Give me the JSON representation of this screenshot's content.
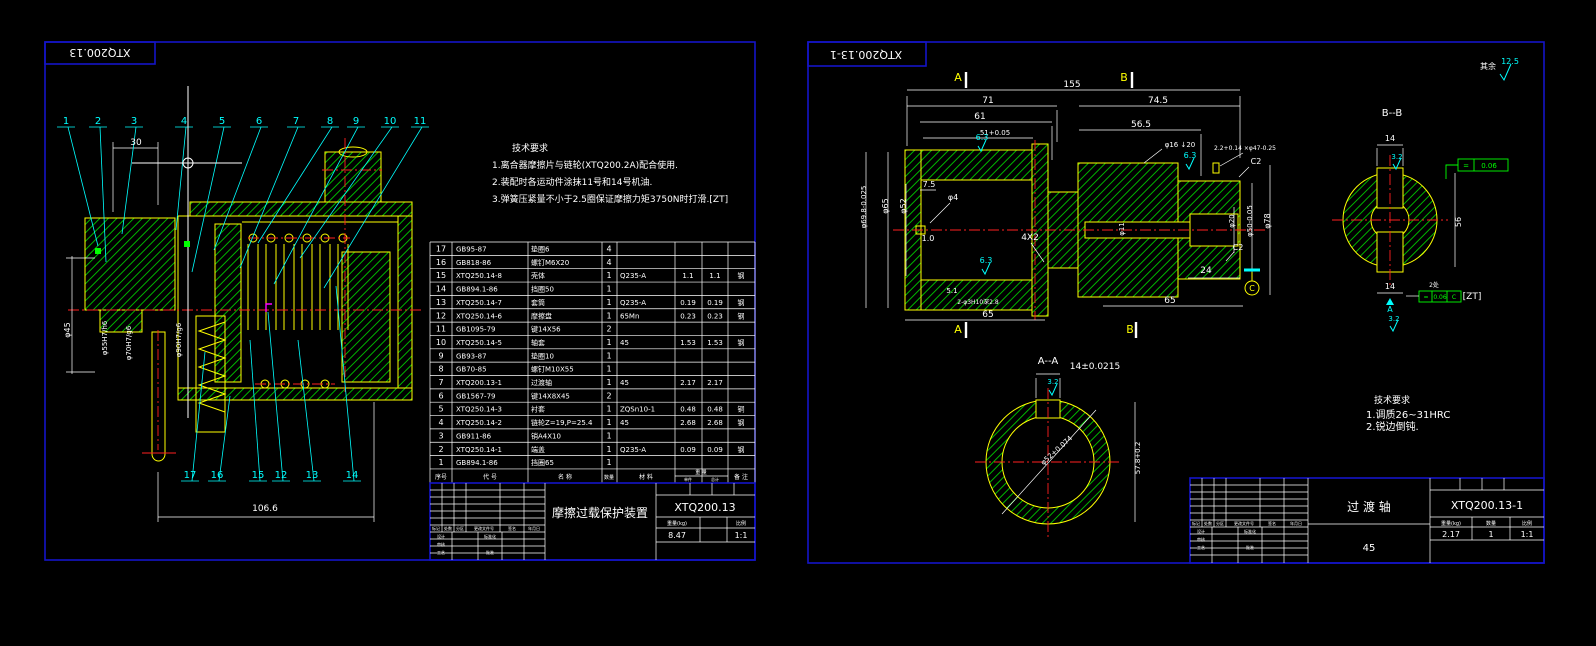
{
  "palette": {
    "background": "#000000",
    "frame_blue": "#1414c8",
    "entity_yellow": "#ffff00",
    "hatch_green": "#00b400",
    "dim_white": "#ffffff",
    "leader_cyan": "#00ffff",
    "center_red": "#ff2020",
    "tolerance_green": "#00ff00",
    "highlight_magenta": "#ff00ff"
  },
  "left_sheet": {
    "corner_label": "XTQ200.13",
    "callouts_top": [
      "1",
      "2",
      "3",
      "4",
      "5",
      "6",
      "7",
      "8",
      "9",
      "10",
      "11"
    ],
    "callouts_bottom": [
      "17",
      "16",
      "15",
      "12",
      "13",
      "14"
    ],
    "dimensions": [
      {
        "t": "30",
        "x": 136,
        "y": 145
      },
      {
        "t": "106.6",
        "x": 265,
        "y": 511
      },
      {
        "t": "φ45",
        "x": 70,
        "y": 330,
        "r": -90,
        "fs": 8
      },
      {
        "t": "φ55H7/h6",
        "x": 107,
        "y": 338,
        "r": -90,
        "fs": 7
      },
      {
        "t": "φ70H7/g6",
        "x": 131,
        "y": 343,
        "r": -90,
        "fs": 7
      },
      {
        "t": "φ90H7/g6",
        "x": 181,
        "y": 340,
        "r": -90,
        "fs": 7
      }
    ],
    "tech_req": {
      "title": "技术要求",
      "lines": [
        "1.离合器摩擦片与链轮(XTQ200.2A)配合使用.",
        "2.装配时各运动件涂抹11号和14号机油.",
        "3.弹簧压紧量不小于2.5圈保证摩擦力矩3750N时打滑.[ZT]"
      ]
    },
    "bom": {
      "header": {
        "no": "序号",
        "code": "代  号",
        "name": "名  称",
        "qty": "数量",
        "mat": "材  料",
        "weight": "重 量",
        "unit": "单件",
        "total": "总计",
        "note": "备  注"
      },
      "rows": [
        [
          "17",
          "GB95-87",
          "垫圈6",
          "4",
          "",
          "",
          "",
          ""
        ],
        [
          "16",
          "GB818-86",
          "螺钉M6X20",
          "4",
          "",
          "",
          "",
          ""
        ],
        [
          "15",
          "XTQ250.14-8",
          "壳体",
          "1",
          "Q235-A",
          "1.1",
          "1.1",
          "钢"
        ],
        [
          "14",
          "GB894.1-86",
          "挡圈50",
          "1",
          "",
          "",
          "",
          ""
        ],
        [
          "13",
          "XTQ250.14-7",
          "套筒",
          "1",
          "Q235-A",
          "0.19",
          "0.19",
          "钢"
        ],
        [
          "12",
          "XTQ250.14-6",
          "摩擦盘",
          "1",
          "65Mn",
          "0.23",
          "0.23",
          "钢"
        ],
        [
          "11",
          "GB1095-79",
          "键14X56",
          "2",
          "",
          "",
          "",
          ""
        ],
        [
          "10",
          "XTQ250.14-5",
          "轴套",
          "1",
          "45",
          "1.53",
          "1.53",
          "钢"
        ],
        [
          "9",
          "GB93-87",
          "垫圈10",
          "1",
          "",
          "",
          "",
          ""
        ],
        [
          "8",
          "GB70-85",
          "螺钉M10X55",
          "1",
          "",
          "",
          "",
          ""
        ],
        [
          "7",
          "XTQ200.13-1",
          "过渡轴",
          "1",
          "45",
          "2.17",
          "2.17",
          ""
        ],
        [
          "6",
          "GB1567-79",
          "键14X8X45",
          "2",
          "",
          "",
          "",
          ""
        ],
        [
          "5",
          "XTQ250.14-3",
          "衬套",
          "1",
          "ZQSn10-1",
          "0.48",
          "0.48",
          "铜"
        ],
        [
          "4",
          "XTQ250.14-2",
          "链轮Z=19,P=25.4",
          "1",
          "45",
          "2.68",
          "2.68",
          "钢"
        ],
        [
          "3",
          "GB911-86",
          "销A4X10",
          "1",
          "",
          "",
          "",
          ""
        ],
        [
          "2",
          "XTQ250.14-1",
          "端盖",
          "1",
          "Q235-A",
          "0.09",
          "0.09",
          "钢"
        ],
        [
          "1",
          "GB894.1-86",
          "挡圈65",
          "1",
          "",
          "",
          "",
          ""
        ]
      ]
    },
    "title_block": {
      "product_name": "摩擦过载保护装置",
      "drawing_no": "XTQ200.13",
      "weight": "8.47",
      "scale": "1:1",
      "labels": {
        "mark": "标记",
        "count": "处数",
        "zone": "分区",
        "doc": "更改文件号",
        "sign": "签名",
        "date": "年月日",
        "design": "设计",
        "check": "审核",
        "process": "工艺",
        "std": "标准化",
        "approve": "批准",
        "weight_kg": "重量(kg)",
        "scale_l": "比例"
      }
    }
  },
  "right_sheet": {
    "corner_label": "XTQ200.13-1",
    "surface_note": {
      "prefix": "其余",
      "roughness": "12.5"
    },
    "section_labels": [
      "A",
      "B",
      "A",
      "B"
    ],
    "dimensions": [
      {
        "t": "155",
        "x": 1072,
        "y": 87
      },
      {
        "t": "71",
        "x": 988,
        "y": 103
      },
      {
        "t": "61",
        "x": 980,
        "y": 119
      },
      {
        "t": "51+0.05",
        "x": 995,
        "y": 135,
        "fs": 7
      },
      {
        "t": "74.5",
        "x": 1158,
        "y": 103
      },
      {
        "t": "56.5",
        "x": 1141,
        "y": 127
      },
      {
        "t": "7.5",
        "x": 929,
        "y": 187,
        "fs": 8
      },
      {
        "t": "φ4",
        "x": 953,
        "y": 200,
        "fs": 8
      },
      {
        "t": "1.0",
        "x": 928,
        "y": 241,
        "fs": 8
      },
      {
        "t": "4X2",
        "x": 1030,
        "y": 240,
        "fs": 9
      },
      {
        "t": "5.1",
        "x": 952,
        "y": 293,
        "fs": 7
      },
      {
        "t": "2-φ3H10深2.8",
        "x": 978,
        "y": 304,
        "fs": 6
      },
      {
        "t": "65",
        "x": 988,
        "y": 317
      },
      {
        "t": "65",
        "x": 1170,
        "y": 303
      },
      {
        "t": "24",
        "x": 1206,
        "y": 273
      },
      {
        "t": "φ16 ↓20",
        "x": 1180,
        "y": 147,
        "fs": 7
      },
      {
        "t": "2.2+0.14 ×φ47-0.25",
        "x": 1245,
        "y": 150,
        "fs": 6
      },
      {
        "t": "C2",
        "x": 1256,
        "y": 164,
        "fs": 8
      },
      {
        "t": "C2",
        "x": 1238,
        "y": 250,
        "fs": 8
      },
      {
        "t": "6.3",
        "x": 982,
        "y": 140,
        "c": "c",
        "fs": 8
      },
      {
        "t": "6.3",
        "x": 1190,
        "y": 158,
        "c": "c",
        "fs": 8
      },
      {
        "t": "6.3",
        "x": 986,
        "y": 263,
        "c": "c",
        "fs": 8
      },
      {
        "t": "φ69.8-0.025",
        "x": 866,
        "y": 207,
        "r": -90,
        "fs": 7
      },
      {
        "t": "φ65",
        "x": 888,
        "y": 206,
        "r": -90,
        "fs": 8
      },
      {
        "t": "φ52",
        "x": 906,
        "y": 206,
        "r": -90,
        "fs": 8
      },
      {
        "t": "φ11",
        "x": 1124,
        "y": 229,
        "r": -90,
        "fs": 7
      },
      {
        "t": "φ20",
        "x": 1234,
        "y": 221,
        "r": -90,
        "fs": 7
      },
      {
        "t": "φ50-0.05",
        "x": 1252,
        "y": 221,
        "r": -90,
        "fs": 7
      },
      {
        "t": "φ78",
        "x": 1270,
        "y": 221,
        "r": -90,
        "fs": 8
      },
      {
        "t": "B--B",
        "x": 1392,
        "y": 116,
        "fs": 10
      },
      {
        "t": "14",
        "x": 1390,
        "y": 141,
        "fs": 8
      },
      {
        "t": "3.2",
        "x": 1397,
        "y": 159,
        "c": "c",
        "fs": 7
      },
      {
        "t": "56",
        "x": 1461,
        "y": 222,
        "r": -90,
        "fs": 8
      },
      {
        "t": "14",
        "x": 1390,
        "y": 289,
        "fs": 8
      },
      {
        "t": "2处",
        "x": 1434,
        "y": 287,
        "fs": 6
      },
      {
        "t": "=",
        "x": 1466,
        "y": 168,
        "c": "g",
        "fs": 7
      },
      {
        "t": "0.06",
        "x": 1489,
        "y": 168,
        "c": "g",
        "fs": 7
      },
      {
        "t": "=",
        "x": 1426,
        "y": 299,
        "c": "g",
        "fs": 6
      },
      {
        "t": "0.06",
        "x": 1440,
        "y": 299,
        "c": "g",
        "fs": 6
      },
      {
        "t": "C",
        "x": 1454,
        "y": 299,
        "c": "g",
        "fs": 6
      },
      {
        "t": "[ZT]",
        "x": 1472,
        "y": 299,
        "fs": 9
      },
      {
        "t": "A",
        "x": 1390,
        "y": 312,
        "c": "c",
        "fs": 8
      },
      {
        "t": "3.2",
        "x": 1394,
        "y": 321,
        "c": "c",
        "fs": 7
      },
      {
        "t": "A--A",
        "x": 1048,
        "y": 364,
        "fs": 10
      },
      {
        "t": "14±0.0215",
        "x": 1095,
        "y": 369,
        "fs": 9
      },
      {
        "t": "3.2",
        "x": 1053,
        "y": 384,
        "c": "c",
        "fs": 7
      },
      {
        "t": "φ52+0.074",
        "x": 1058,
        "y": 452,
        "r": -42,
        "fs": 7
      },
      {
        "t": "57.8+0.2",
        "x": 1140,
        "y": 458,
        "r": -90,
        "fs": 7
      },
      {
        "t": "其余",
        "x": 1488,
        "y": 69,
        "fs": 8
      },
      {
        "t": "12.5",
        "x": 1510,
        "y": 64,
        "c": "c",
        "fs": 8
      },
      {
        "t": "C",
        "x": 1252,
        "y": 291,
        "c": "y",
        "fs": 8
      }
    ],
    "tech_req": {
      "title": "技术要求",
      "lines": [
        "1.调质26~31HRC",
        "2.锐边倒钝."
      ]
    },
    "title_block": {
      "part_name": "过 渡 轴",
      "drawing_no": "XTQ200.13-1",
      "weight": "2.17",
      "qty": "1",
      "scale": "1:1",
      "material": "45",
      "labels": {
        "mark": "标记",
        "count": "处数",
        "zone": "分区",
        "doc": "更改文件号",
        "sign": "签名",
        "date": "年月日",
        "design": "设计",
        "check": "审核",
        "process": "工艺",
        "std": "标准化",
        "approve": "批准",
        "weight_kg": "重量(kg)",
        "qty_l": "数量",
        "scale_l": "比例"
      }
    }
  }
}
